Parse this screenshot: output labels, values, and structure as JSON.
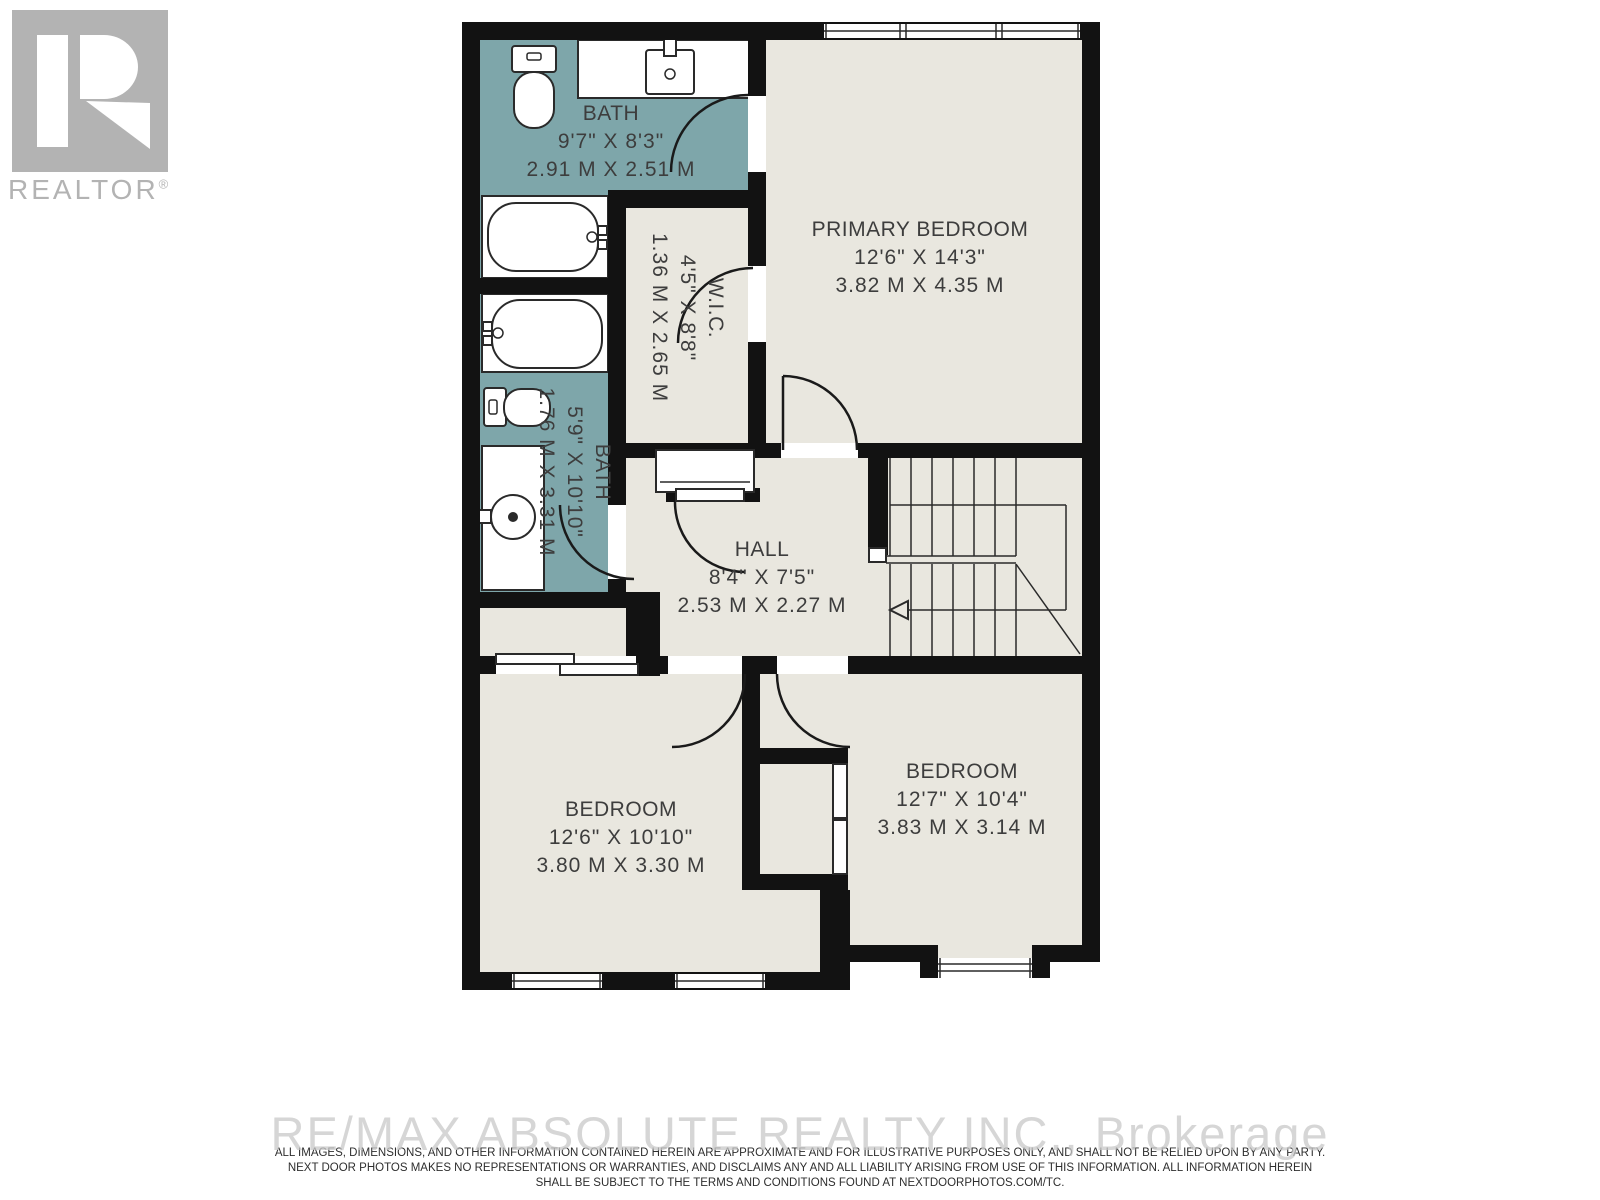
{
  "branding": {
    "logo_text": "REALTOR",
    "logo_reg": "®",
    "watermark": "RE/MAX ABSOLUTE REALTY INC., Brokerage"
  },
  "disclaimer": {
    "line1": "ALL IMAGES, DIMENSIONS, AND OTHER INFORMATION CONTAINED HEREIN ARE APPROXIMATE AND FOR ILLUSTRATIVE PURPOSES ONLY, AND SHALL NOT BE RELIED UPON BY ANY PARTY.",
    "line2": "NEXT DOOR PHOTOS MAKES NO REPRESENTATIONS OR WARRANTIES, AND DISCLAIMS ANY AND ALL LIABILITY ARISING FROM USE OF THIS INFORMATION. ALL INFORMATION HEREIN",
    "line3": "SHALL BE SUBJECT TO THE TERMS AND CONDITIONS FOUND AT NEXTDOORPHOTOS.COM/TC."
  },
  "rooms": {
    "bath_top": {
      "name": "BATH",
      "imperial": "9'7\" X 8'3\"",
      "metric": "2.91 M X 2.51 M"
    },
    "primary": {
      "name": "PRIMARY BEDROOM",
      "imperial": "12'6\" X 14'3\"",
      "metric": "3.82 M X 4.35 M"
    },
    "wic": {
      "name": "W.I.C.",
      "imperial": "4'5\" X 8'8\"",
      "metric": "1.36 M X 2.65 M"
    },
    "bath_main": {
      "name": "BATH",
      "imperial": "5'9\" X 10'10\"",
      "metric": "1.76 M X 3.31 M"
    },
    "hall": {
      "name": "HALL",
      "imperial": "8'4\" X 7'5\"",
      "metric": "2.53 M X 2.27 M"
    },
    "bedroom_left": {
      "name": "BEDROOM",
      "imperial": "12'6\" X 10'10\"",
      "metric": "3.80 M X 3.30 M"
    },
    "bedroom_right": {
      "name": "BEDROOM",
      "imperial": "12'7\" X 10'4\"",
      "metric": "3.83 M X 3.14 M"
    }
  },
  "colors": {
    "bath_fill": "#7EA6AA",
    "floor_fill": "#E9E7DF",
    "wall": "#121212",
    "logo_gray": "#B3B3B3",
    "watermark_gray": "#C9C9C9"
  }
}
